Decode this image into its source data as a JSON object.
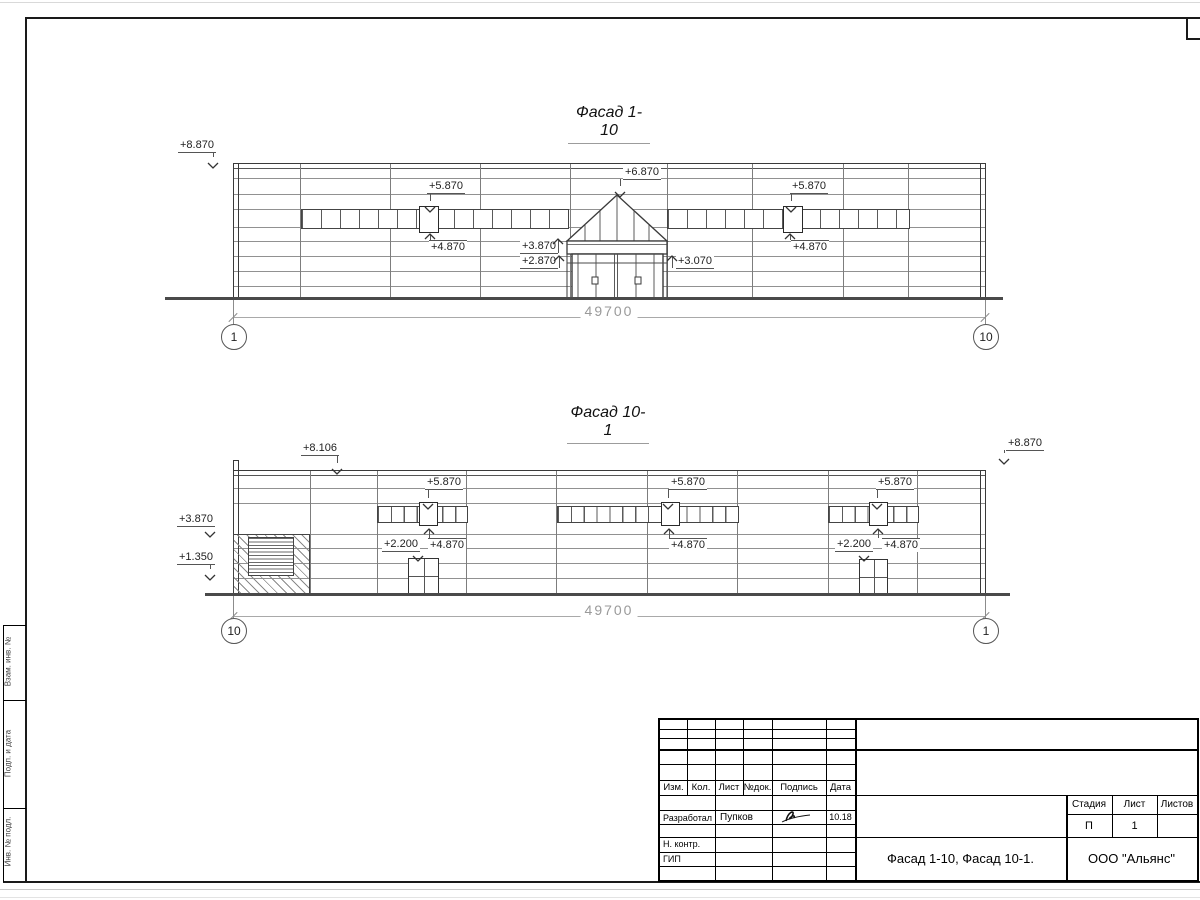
{
  "drawing": {
    "facade1": {
      "title": "Фасад 1-10",
      "dimension": "49700",
      "axis_left": "1",
      "axis_right": "10"
    },
    "facade2": {
      "title": "Фасад 10-1",
      "dimension": "49700",
      "axis_left": "10",
      "axis_right": "1"
    },
    "marks": [
      {
        "text": "+8.870",
        "lx": 178,
        "ly": 139,
        "ax": 213,
        "ay": 163,
        "dir": "down",
        "shelf": "b"
      },
      {
        "text": "+5.870",
        "lx": 427,
        "ly": 180,
        "ax": 430,
        "ay": 207,
        "dir": "down",
        "shelf": "b"
      },
      {
        "text": "+4.870",
        "lx": 429,
        "ly": 240,
        "ax": 430,
        "ay": 227,
        "dir": "up",
        "shelf": "a"
      },
      {
        "text": "+6.870",
        "lx": 623,
        "ly": 166,
        "ax": 620,
        "ay": 192,
        "dir": "down",
        "shelf": "b"
      },
      {
        "text": "+3.870",
        "lx": 520,
        "ly": 240,
        "ax": 558,
        "ay": 232,
        "dir": "up",
        "shelf": "b"
      },
      {
        "text": "+2.870",
        "lx": 520,
        "ly": 255,
        "ax": 559,
        "ay": 249,
        "dir": "up",
        "shelf": "b"
      },
      {
        "text": "+3.070",
        "lx": 676,
        "ly": 255,
        "ax": 672,
        "ay": 249,
        "dir": "up",
        "shelf": "b"
      },
      {
        "text": "+5.870",
        "lx": 790,
        "ly": 180,
        "ax": 791,
        "ay": 207,
        "dir": "down",
        "shelf": "b"
      },
      {
        "text": "+4.870",
        "lx": 791,
        "ly": 240,
        "ax": 790,
        "ay": 227,
        "dir": "up",
        "shelf": "a"
      },
      {
        "text": "+8.106",
        "lx": 301,
        "ly": 442,
        "ax": 337,
        "ay": 469,
        "dir": "down",
        "shelf": "b"
      },
      {
        "text": "+8.870",
        "lx": 1006,
        "ly": 437,
        "ax": 1004,
        "ay": 459,
        "dir": "down",
        "shelf": "b"
      },
      {
        "text": "+3.870",
        "lx": 177,
        "ly": 513,
        "ax": 210,
        "ay": 532,
        "dir": "down",
        "shelf": "b"
      },
      {
        "text": "+1.350",
        "lx": 177,
        "ly": 551,
        "ax": 210,
        "ay": 575,
        "dir": "down",
        "shelf": "b"
      },
      {
        "text": "+5.870",
        "lx": 425,
        "ly": 476,
        "ax": 428,
        "ay": 504,
        "dir": "down",
        "shelf": "b"
      },
      {
        "text": "+4.870",
        "lx": 428,
        "ly": 538,
        "ax": 429,
        "ay": 522,
        "dir": "up",
        "shelf": "a"
      },
      {
        "text": "+2.200",
        "lx": 382,
        "ly": 538,
        "ax": 418,
        "ay": 556,
        "dir": "down",
        "shelf": "b"
      },
      {
        "text": "+5.870",
        "lx": 669,
        "ly": 476,
        "ax": 668,
        "ay": 504,
        "dir": "down",
        "shelf": "b"
      },
      {
        "text": "+4.870",
        "lx": 669,
        "ly": 538,
        "ax": 669,
        "ay": 522,
        "dir": "up",
        "shelf": "a"
      },
      {
        "text": "+5.870",
        "lx": 876,
        "ly": 476,
        "ax": 877,
        "ay": 504,
        "dir": "down",
        "shelf": "b"
      },
      {
        "text": "+4.870",
        "lx": 882,
        "ly": 538,
        "ax": 878,
        "ay": 522,
        "dir": "up",
        "shelf": "a"
      },
      {
        "text": "+2.200",
        "lx": 835,
        "ly": 538,
        "ax": 864,
        "ay": 556,
        "dir": "down",
        "shelf": "b"
      }
    ],
    "dimensions": [
      {
        "text": "49700",
        "x1": 233,
        "x2": 985,
        "y": 317,
        "text_y": 303,
        "text_x": 609
      },
      {
        "text": "49700",
        "x1": 233,
        "x2": 985,
        "y": 616,
        "text_y": 602,
        "text_x": 609
      }
    ],
    "axes": [
      {
        "label": "1",
        "cx": 233,
        "cy": 336,
        "ly1": 300,
        "ly2": 324
      },
      {
        "label": "10",
        "cx": 985,
        "cy": 336,
        "ly1": 300,
        "ly2": 324
      },
      {
        "label": "10",
        "cx": 233,
        "cy": 630,
        "ly1": 596,
        "ly2": 618
      },
      {
        "label": "1",
        "cx": 985,
        "cy": 630,
        "ly1": 596,
        "ly2": 618
      }
    ]
  },
  "stamp": {
    "header_cols": [
      "Изм.",
      "Кол.",
      "Лист",
      "№док.",
      "Подпись",
      "Дата"
    ],
    "developer_role": "Разработал",
    "developer_name": "Пупков",
    "developer_date": "10.18",
    "n_contr_label": "Н. контр.",
    "gip_label": "ГИП",
    "doc_title": "Фасад 1-10, Фасад 10-1.",
    "company": "ООО \"Альянс\"",
    "stage_label": "Стадия",
    "sheet_label": "Лист",
    "sheets_label": "Листов",
    "stage_value": "П",
    "sheet_value": "1",
    "sheets_value": ""
  },
  "margin": {
    "labels": [
      "Взам. инв. №",
      "Подп. и дата",
      "Инв. № подл."
    ]
  }
}
